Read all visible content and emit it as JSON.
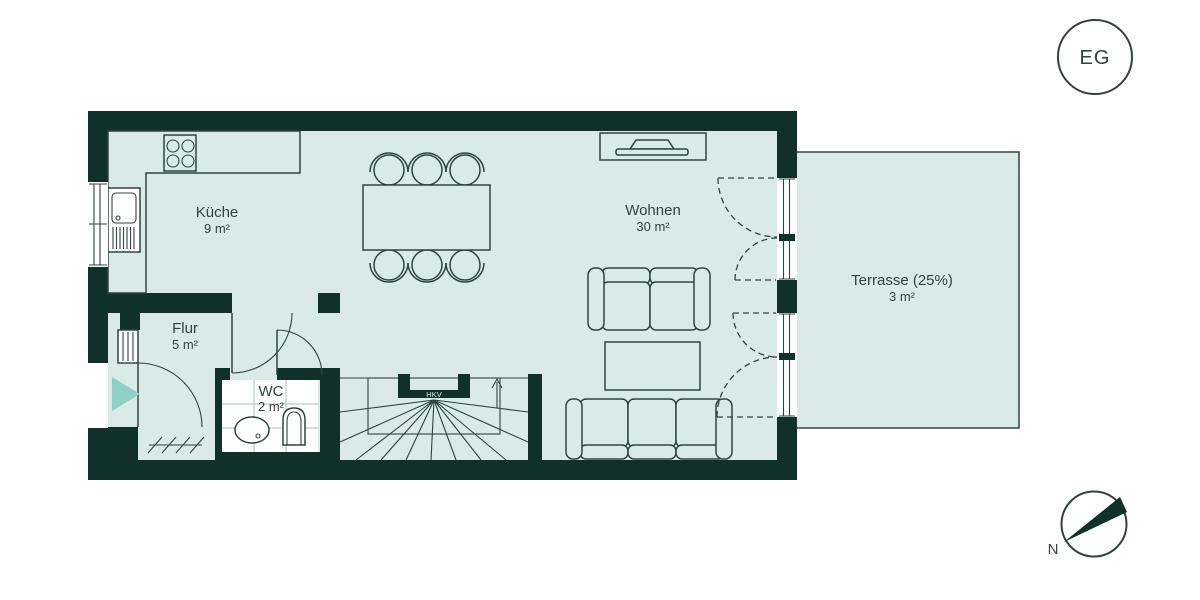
{
  "plan": {
    "floor_tag": "EG",
    "compass_label": "N",
    "rooms": [
      {
        "name": "Küche",
        "area": "9 m²"
      },
      {
        "name": "Wohnen",
        "area": "30 m²"
      },
      {
        "name": "Flur",
        "area": "5 m²"
      },
      {
        "name": "WC",
        "area": "2 m²"
      },
      {
        "name": "Terrasse (25%)",
        "area": "3 m²"
      }
    ],
    "labels": {
      "hkv": "HKV"
    },
    "colors": {
      "wall": "#10312a",
      "floor": "#d9eae7",
      "line": "#2f4441",
      "text": "#33423f",
      "accent_arrow": "#8ed0c5",
      "background": "#ffffff"
    }
  }
}
